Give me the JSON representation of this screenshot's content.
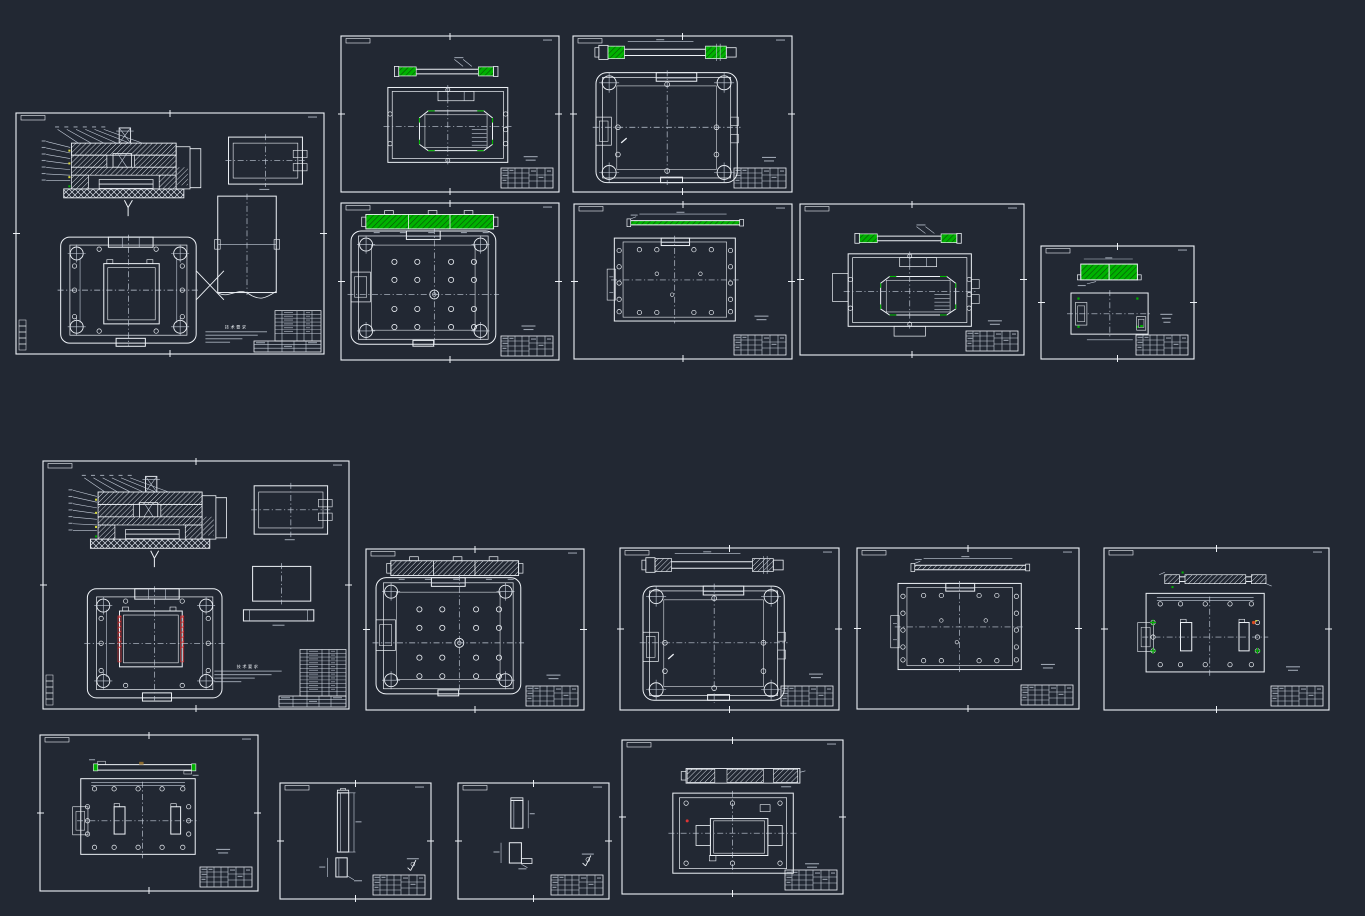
{
  "canvas": {
    "background": "#222833",
    "width": 1365,
    "height": 916
  },
  "palette": {
    "line": "#eef2f7",
    "dim": "#c6cedb",
    "hatch": "#dde3eb",
    "green": "#00b200",
    "green_dark": "#0a4d0a",
    "red": "#e03434",
    "orange_red": "#d84a20",
    "yellow": "#d6d839",
    "brown": "#8a6a2e"
  },
  "notes_heading": "技术要求",
  "sheets": [
    {
      "id": "assembly-top",
      "kind": "assembly",
      "variant": "a",
      "x": 16,
      "y": 113,
      "w": 308,
      "h": 241,
      "title": "bom"
    },
    {
      "id": "cavity-plate-highlight",
      "kind": "cavity",
      "variant": "plain",
      "x": 341,
      "y": 36,
      "w": 218,
      "h": 156,
      "accent": "green",
      "title": "small"
    },
    {
      "id": "clamp-plate-highlight",
      "kind": "lobed",
      "x": 573,
      "y": 36,
      "w": 219,
      "h": 156,
      "accent": "green",
      "title": "small"
    },
    {
      "id": "support-plate-highlight",
      "kind": "holes",
      "x": 341,
      "y": 203,
      "w": 218,
      "h": 157,
      "accent": "green",
      "title": "small"
    },
    {
      "id": "thin-plate-highlight",
      "kind": "flat",
      "x": 574,
      "y": 204,
      "w": 218,
      "h": 155,
      "accent": "green",
      "title": "small"
    },
    {
      "id": "core-plate-highlight",
      "kind": "cavity",
      "variant": "flanged",
      "x": 800,
      "y": 204,
      "w": 224,
      "h": 151,
      "accent": "green",
      "title": "small"
    },
    {
      "id": "insert-block-highlight",
      "kind": "small",
      "x": 1041,
      "y": 246,
      "w": 153,
      "h": 113,
      "accent": "green",
      "title": "small"
    },
    {
      "id": "assembly-bottom",
      "kind": "assembly",
      "variant": "b",
      "x": 43,
      "y": 461,
      "w": 306,
      "h": 248,
      "title": "bom"
    },
    {
      "id": "support-plate",
      "kind": "holes",
      "x": 366,
      "y": 549,
      "w": 218,
      "h": 161,
      "accent": "white",
      "title": "small"
    },
    {
      "id": "clamp-plate",
      "kind": "lobed",
      "x": 620,
      "y": 548,
      "w": 219,
      "h": 162,
      "accent": "white",
      "title": "small"
    },
    {
      "id": "thin-plate",
      "kind": "flat",
      "x": 857,
      "y": 548,
      "w": 222,
      "h": 161,
      "accent": "white",
      "title": "small"
    },
    {
      "id": "ejector-plate-marked",
      "kind": "slots",
      "variant": "hatch",
      "x": 1104,
      "y": 548,
      "w": 225,
      "h": 162,
      "title": "small"
    },
    {
      "id": "ejector-plate",
      "kind": "slots",
      "variant": "greenends",
      "x": 40,
      "y": 735,
      "w": 218,
      "h": 156,
      "title": "small"
    },
    {
      "id": "guide-pin",
      "kind": "pin",
      "x": 280,
      "y": 783,
      "w": 151,
      "h": 116,
      "title": "small"
    },
    {
      "id": "stop-block",
      "kind": "block",
      "x": 458,
      "y": 783,
      "w": 151,
      "h": 116,
      "title": "small"
    },
    {
      "id": "moving-mold-plate",
      "kind": "boss",
      "x": 622,
      "y": 740,
      "w": 221,
      "h": 154,
      "title": "small"
    }
  ]
}
